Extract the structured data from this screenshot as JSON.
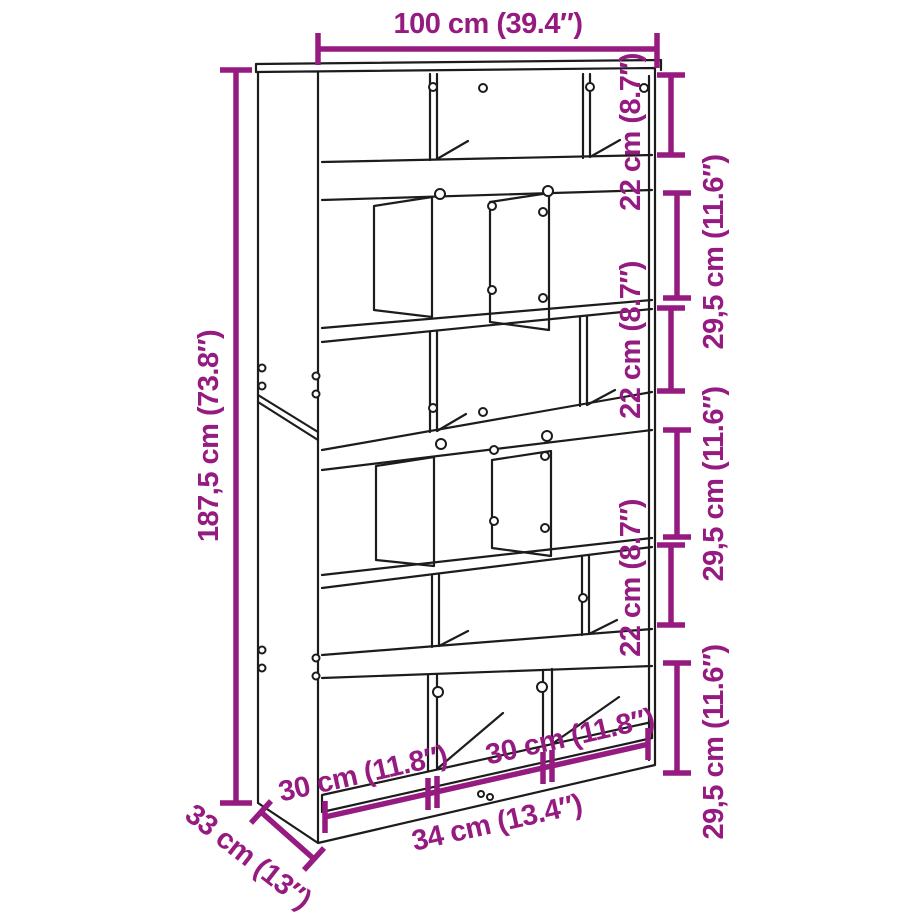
{
  "diagram": {
    "title": "bookcase-dimension-diagram",
    "colors": {
      "dimension": "#951b81",
      "outline": "#1c1c1c",
      "background": "#ffffff"
    },
    "labels": {
      "total_width": "100 cm (39.4″)",
      "total_height": "187,5 cm (73.8″)",
      "compartment_height": "22 cm (8.7″)",
      "row_height": "29,5 cm (11.6″)",
      "compartment_width": "30 cm (11.8″)",
      "middle_compartment_width": "34 cm (13.4″)",
      "depth": "33 cm (13″)"
    }
  }
}
